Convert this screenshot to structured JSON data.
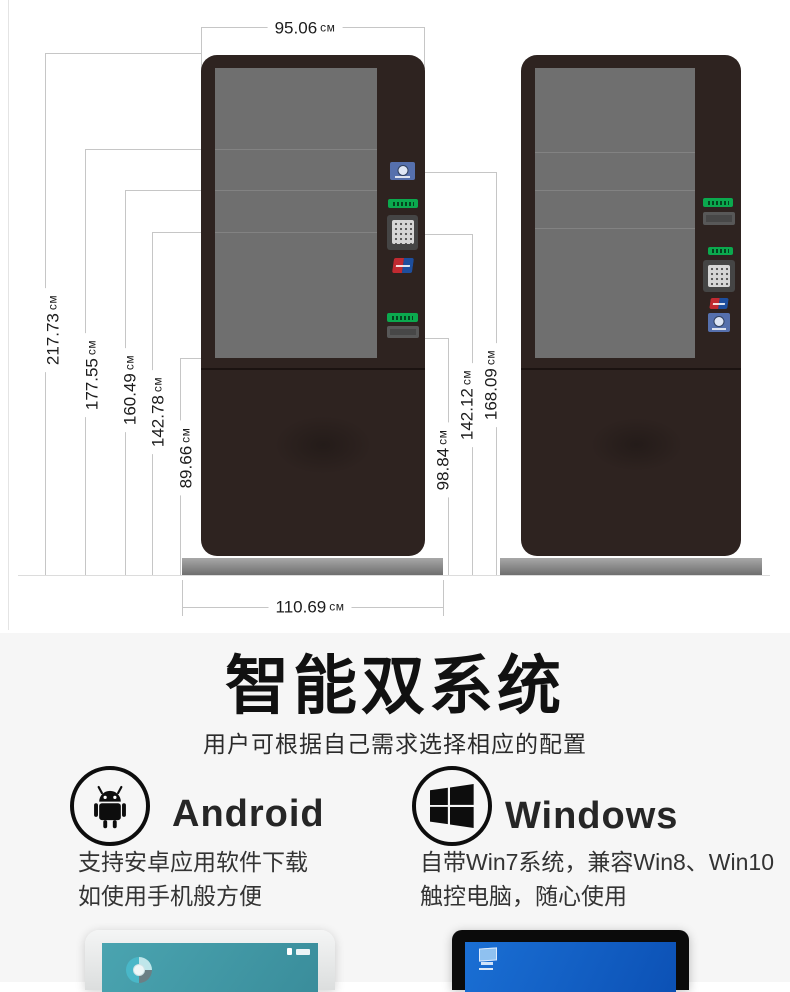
{
  "product_diagram": {
    "unit": "см",
    "top_width": "95.06",
    "heights_left": [
      "217.73",
      "177.55",
      "160.49",
      "142.78",
      "89.66"
    ],
    "heights_middle": [
      "98.84",
      "142.12",
      "168.09"
    ],
    "bottom_width": "110.69",
    "icons": {
      "left_kiosk_modules": [
        "camera-module-icon",
        "card-entry-green-label",
        "pin-keypad-icon",
        "unionpay-logo-icon",
        "receipt-green-label",
        "receipt-slot"
      ],
      "right_kiosk_modules": [
        "receipt-green-label",
        "receipt-slot",
        "card-entry-green-label",
        "pin-keypad-icon",
        "unionpay-logo-icon",
        "camera-module-icon"
      ]
    }
  },
  "dual_system": {
    "title": "智能双系统",
    "subtitle": "用户可根据自己需求选择相应的配置",
    "android": {
      "name": "Android",
      "icon": "android-robot-icon",
      "desc1": "支持安卓应用软件下载",
      "desc2": "如使用手机般方便"
    },
    "windows": {
      "name": "Windows",
      "icon": "windows-logo-icon",
      "desc1": "自带Win7系统，兼容Win8、Win10",
      "desc2": "触控电脑，随心使用"
    }
  },
  "colors": {
    "kiosk_body": "#2e2320",
    "kiosk_screen": "#6f6f6f",
    "base_gray": "#8f8f8f",
    "green_label": "#0ba94e",
    "module_blue": "#5670ad",
    "unionpay_red": "#c12a31",
    "unionpay_blue": "#1d4e9e",
    "android_desktop_teal": "#459ca9",
    "windows_desktop_blue": "#1463c6",
    "section_bg": "#f6f6f6",
    "dimension_line": "#c6c6c6"
  }
}
